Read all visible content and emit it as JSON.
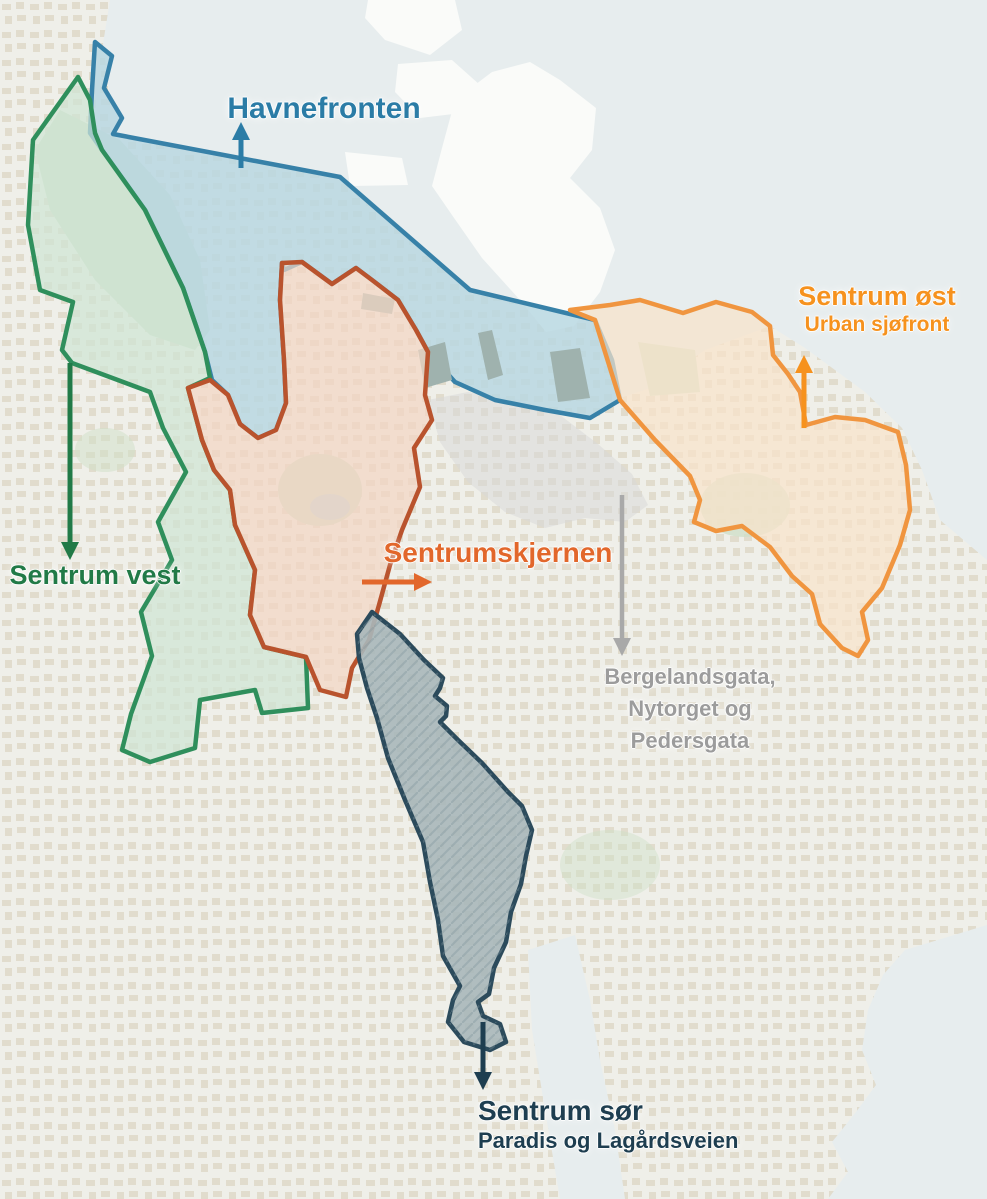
{
  "map": {
    "colors": {
      "background": "#efefe9",
      "sea": "#e7edee",
      "building": "#dcd4c2",
      "island": "#fafbf9",
      "park": "#cfdfc8",
      "lake": "#b9d5dc",
      "pier": "#9fb2ae"
    }
  },
  "zones": {
    "havnefronten": {
      "label": "Havnefronten",
      "text_color": "#2b7ca6",
      "fill": "#b7d7e2",
      "stroke": "#3781a8"
    },
    "sentrum_vest": {
      "label": "Sentrum vest",
      "text_color": "#217a47",
      "fill": "#cfe5d4",
      "stroke": "#2f8f5c"
    },
    "sentrumskjernen": {
      "label": "Sentrumskjernen",
      "text_color": "#e2672b",
      "fill": "#f2d6c3",
      "stroke": "#b9532d"
    },
    "sentrum_ost": {
      "label": "Sentrum øst",
      "sublabel": "Urban sjøfront",
      "text_color": "#f6921e",
      "fill": "#f8e3cb",
      "stroke": "#f0953f"
    },
    "bergelandsgata": {
      "lines": [
        "Bergelandsgata,",
        "Nytorget og",
        "Pedersgata"
      ],
      "text_color": "#9c9c9c",
      "arrow_color": "#a9a9a9",
      "fill": "#d8d8d8"
    },
    "sentrum_sor": {
      "label": "Sentrum sør",
      "sublabel": "Paradis og Lagårdsveien",
      "text_color": "#1e3e50",
      "fill": "#a9b7ba",
      "stroke": "#2c4b5c"
    }
  }
}
